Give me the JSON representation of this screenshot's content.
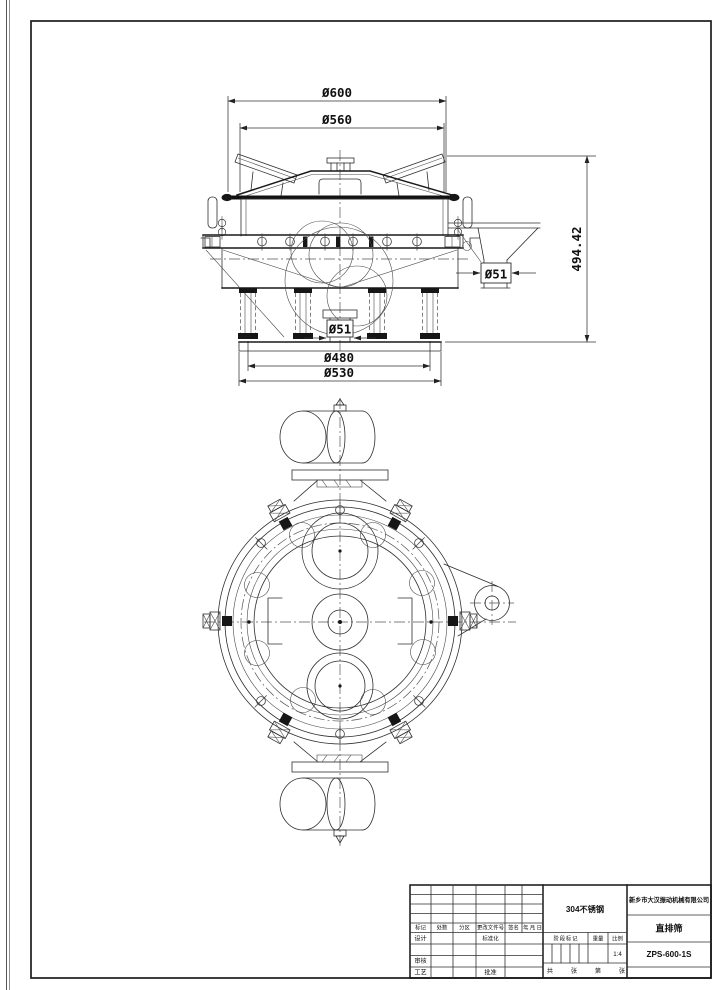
{
  "front_view": {
    "dimensions": {
      "lid_outer": "Ø600",
      "screen_frame": "Ø560",
      "overall_height": "494.42",
      "side_outlet": "Ø51",
      "bottom_outlet": "Ø51",
      "spring_circle": "Ø480",
      "base_outer": "Ø530"
    }
  },
  "title_block": {
    "material": "304不锈钢",
    "company": "新乡市大汉振动机械有限公司",
    "product": "直排筛",
    "drawing_no": "ZPS-600-1S",
    "scale_value": "1:4",
    "revision_headers": [
      "标记",
      "处数",
      "分区",
      "更改文件号",
      "签名",
      "年、月、日"
    ],
    "labels": {
      "design": "设计",
      "standardization": "标准化",
      "review": "审核",
      "process": "工艺",
      "approve": "批准",
      "stage_mark": "阶段标记",
      "weight": "重量",
      "scale": "比例",
      "sheet_total_prefix": "共",
      "sheet_total_suffix": "张",
      "sheet_no_prefix": "第",
      "sheet_no_suffix": "张"
    }
  }
}
